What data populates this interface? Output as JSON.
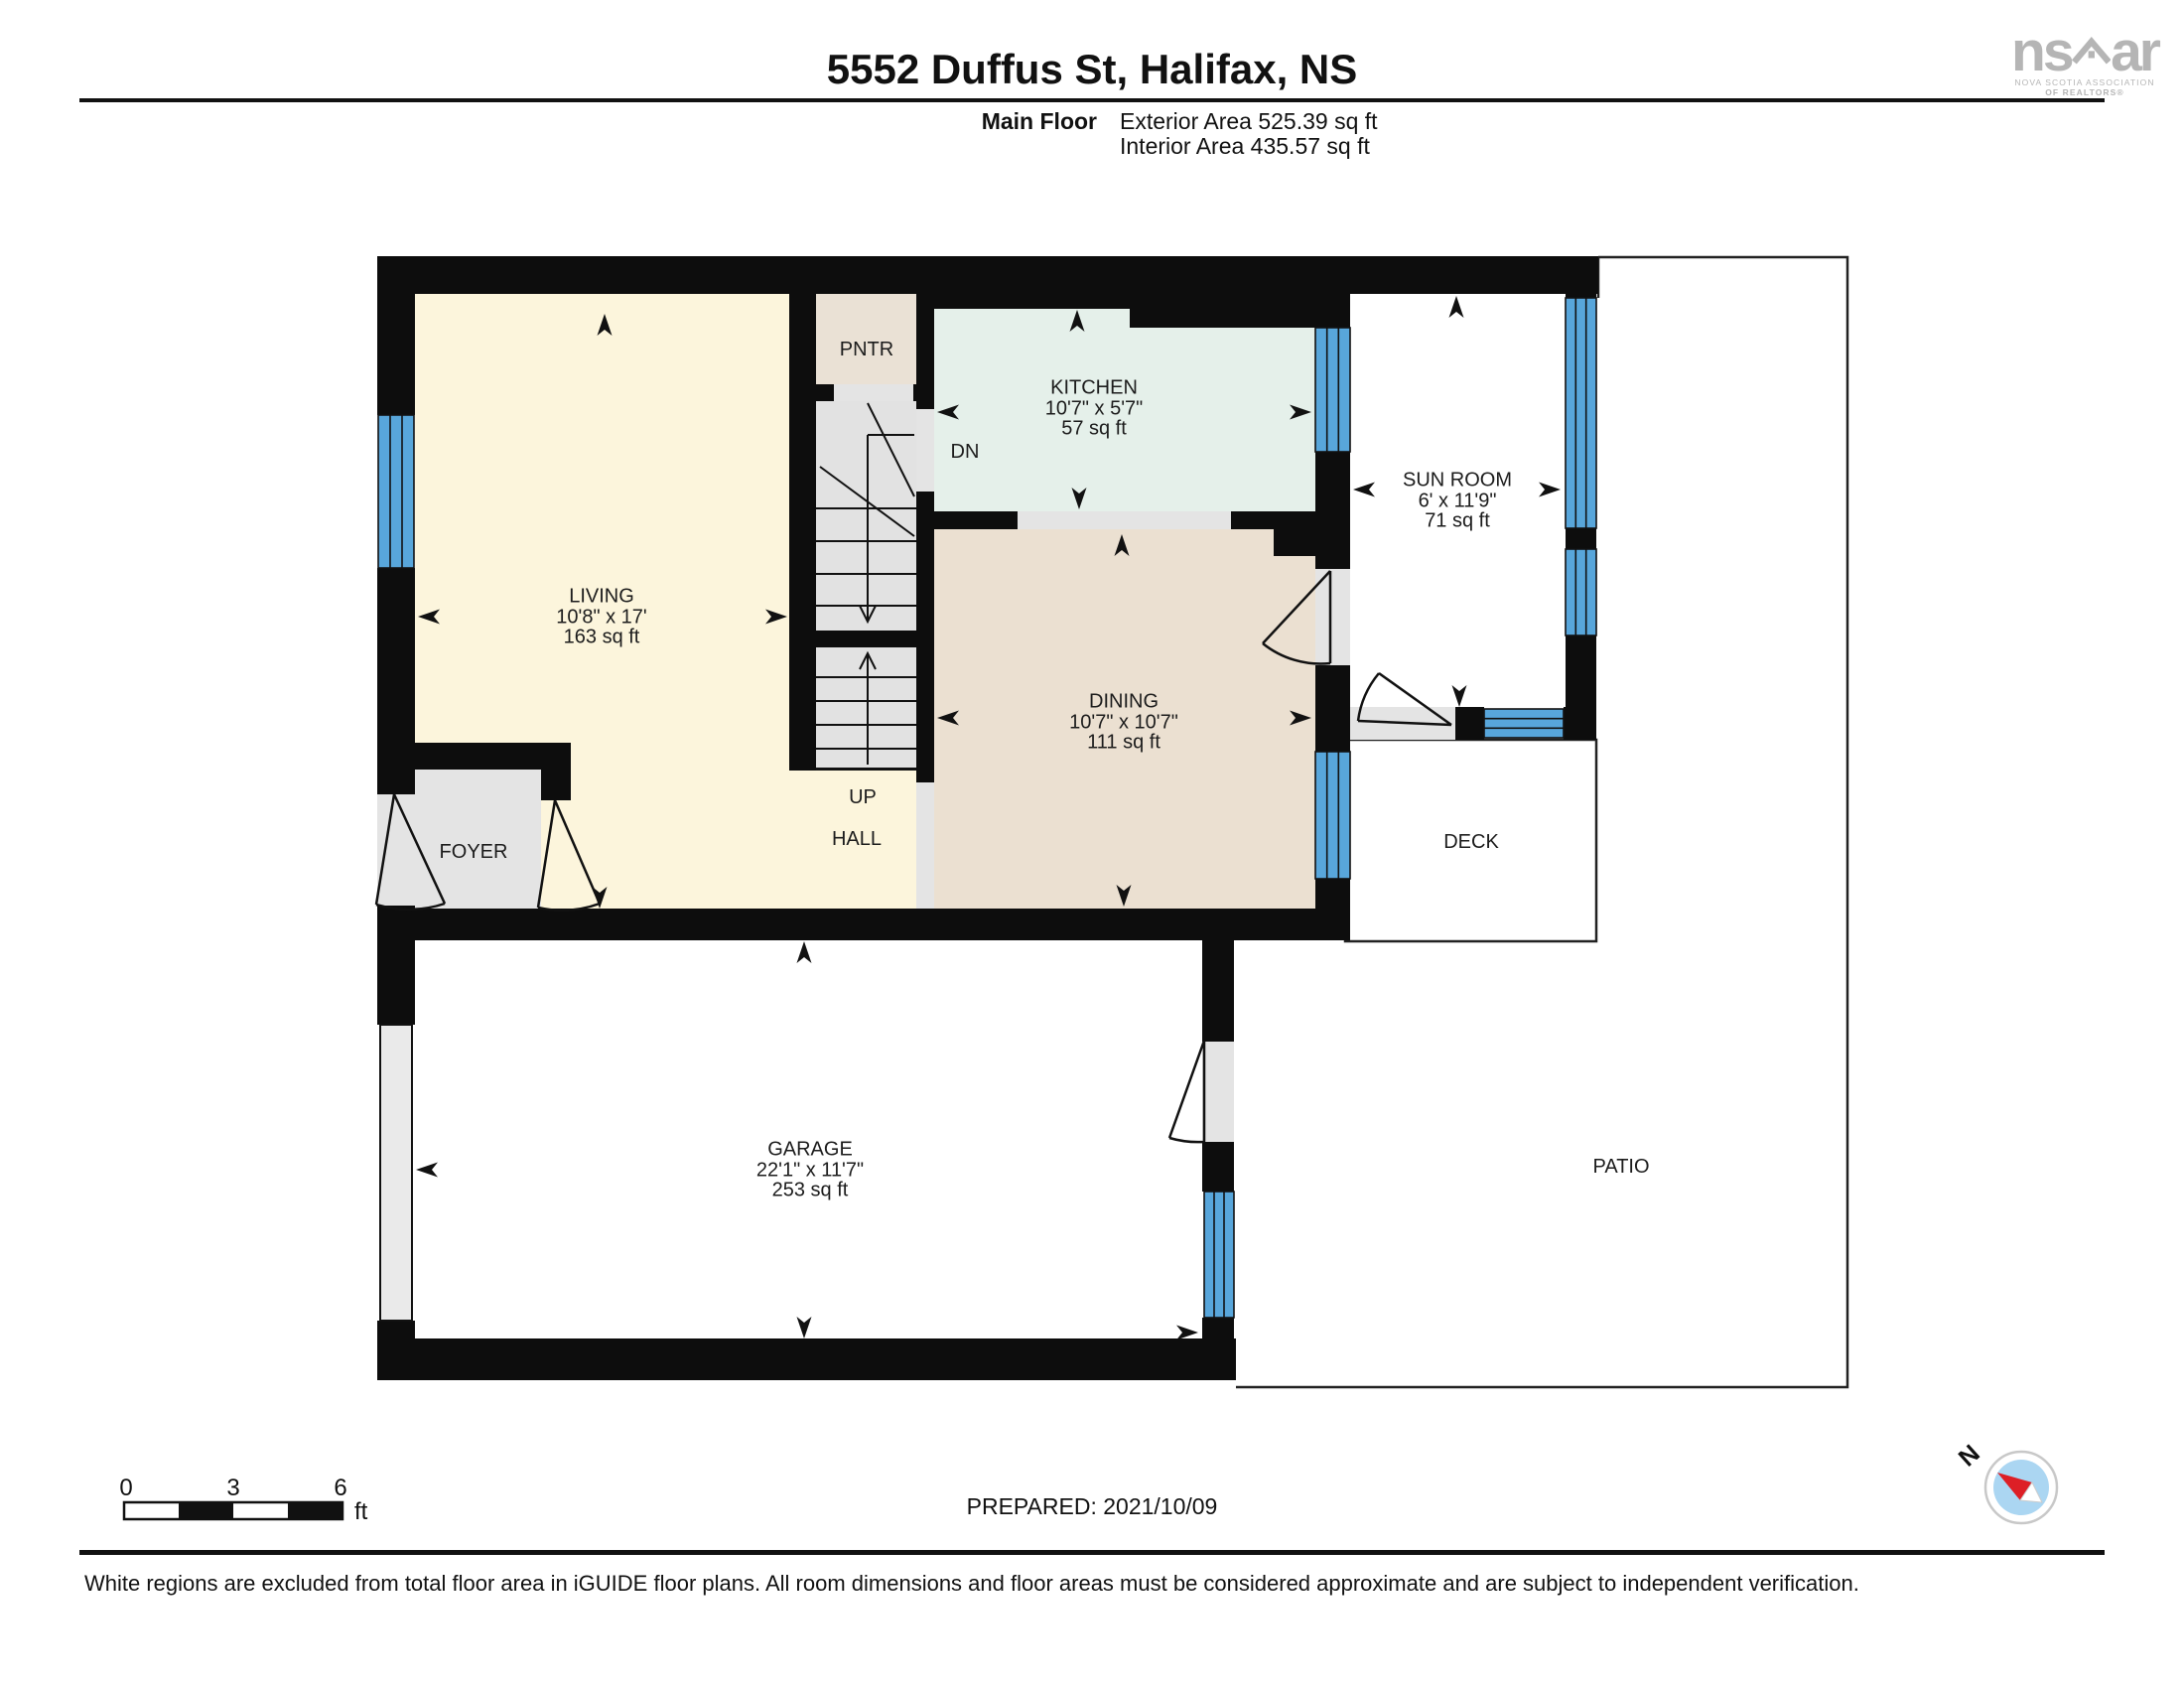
{
  "header": {
    "title": "5552 Duffus St, Halifax, NS",
    "floor_label": "Main Floor",
    "exterior_area": "Exterior Area 525.39 sq ft",
    "interior_area": "Interior Area 435.57 sq ft"
  },
  "logo": {
    "left": "ns",
    "right": "ar",
    "line1": "NOVA SCOTIA ASSOCIATION",
    "line2": "OF REALTORS®"
  },
  "rooms": {
    "living": {
      "name": "LIVING",
      "dims": "10'8\" x 17'",
      "area": "163 sq ft"
    },
    "kitchen": {
      "name": "KITCHEN",
      "dims": "10'7\" x 5'7\"",
      "area": "57 sq ft"
    },
    "dining": {
      "name": "DINING",
      "dims": "10'7\" x 10'7\"",
      "area": "111 sq ft"
    },
    "sunroom": {
      "name": "SUN ROOM",
      "dims": "6' x 11'9\"",
      "area": "71 sq ft"
    },
    "garage": {
      "name": "GARAGE",
      "dims": "22'1\" x 11'7\"",
      "area": "253 sq ft"
    },
    "pantry": {
      "name": "PNTR"
    },
    "foyer": {
      "name": "FOYER"
    },
    "hall": {
      "name": "HALL"
    },
    "deck": {
      "name": "DECK"
    },
    "patio": {
      "name": "PATIO"
    },
    "stair_up": "UP",
    "stair_dn": "DN"
  },
  "scale_bar": {
    "tick0": "0",
    "tick1": "3",
    "tick2": "6",
    "unit": "ft"
  },
  "compass": {
    "label": "N"
  },
  "footer": {
    "prepared": "PREPARED: 2021/10/09",
    "disclaimer": "White regions are excluded from total floor area in iGUIDE floor plans. All room dimensions and floor areas must be considered approximate and are subject to independent verification."
  },
  "colors": {
    "wall": "#0d0d0d",
    "window_blue": "#58A6DB",
    "living_floor": "#FCF5DC",
    "kitchen_floor": "#E5F0EA",
    "dining_floor": "#EBE0D1",
    "pantry_floor": "#EAE1D5",
    "gray_floor": "#E4E4E4",
    "compass_red": "#DD1F26",
    "compass_blue": "#ABD6F2",
    "logo_gray": "#B5B5B5"
  }
}
